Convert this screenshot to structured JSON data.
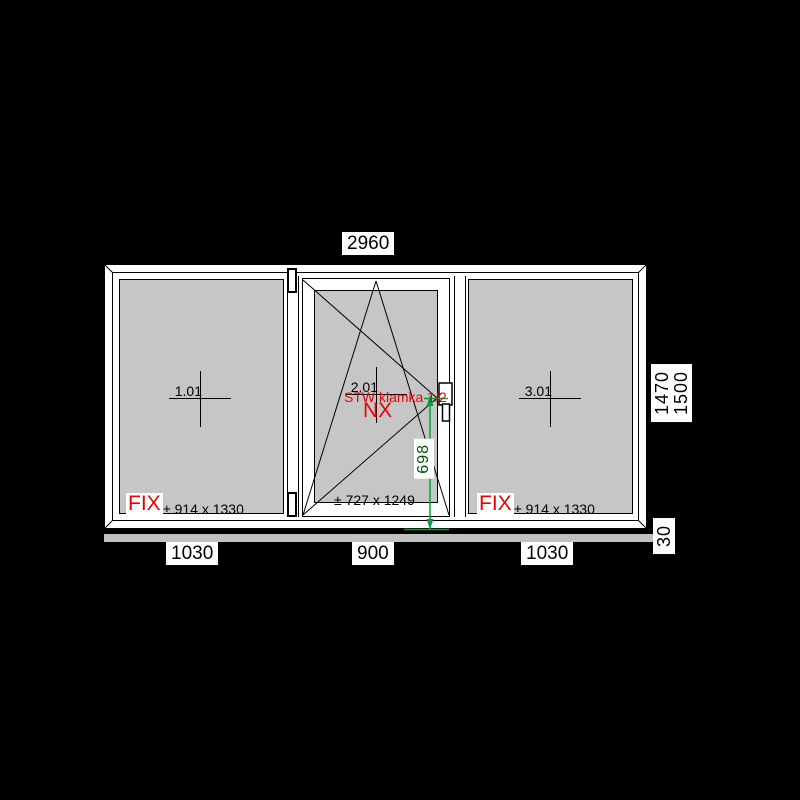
{
  "drawing_type": "window-technical-drawing",
  "dimensions": {
    "total_width": "2960",
    "bottom_widths": [
      "1030",
      "900",
      "1030"
    ],
    "frame_height": "1470",
    "total_height": "1500",
    "sill": "30",
    "handle_height": "698"
  },
  "panels": [
    {
      "number": "1.01",
      "type": "FIX",
      "glass_size": "± 914 x 1330",
      "width": "1030"
    },
    {
      "number": "2.01",
      "type": "NX",
      "hardware": "STW klamka 1/2",
      "glass_size": "± 727 x 1249",
      "width": "900"
    },
    {
      "number": "3.01",
      "type": "FIX",
      "glass_size": "± 914 x 1330",
      "width": "1030"
    }
  ],
  "colors": {
    "background": "#000000",
    "frame": "#ffffff",
    "glass": "#c6c6c6",
    "accent_red": "#ee0000",
    "dimension_green": "#00a33a",
    "line_black": "#000000"
  }
}
